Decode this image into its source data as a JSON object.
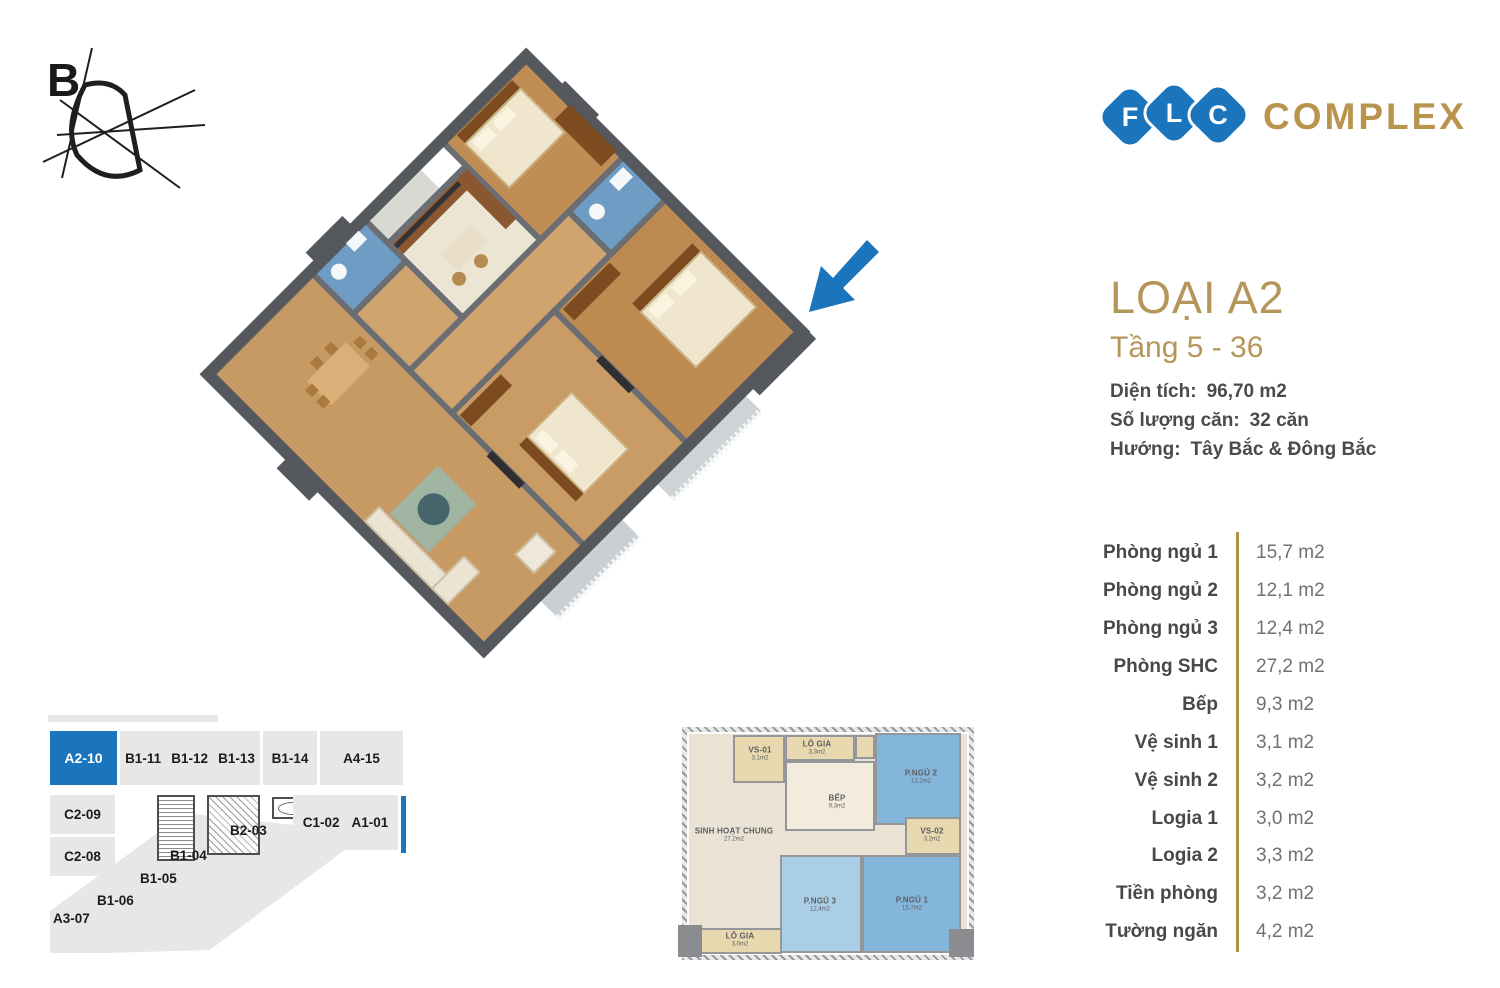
{
  "compass": {
    "label": "B"
  },
  "logo": {
    "letters": [
      "F",
      "L",
      "C"
    ],
    "word": "COMPLEX",
    "blue": "#1b75bc",
    "gold": "#b8944e"
  },
  "header": {
    "title": "LOẠI A2",
    "subtitle": "Tầng 5 - 36"
  },
  "info": {
    "rows": [
      {
        "label": "Diện tích:",
        "value": "96,70 m2"
      },
      {
        "label": "Số lượng căn:",
        "value": "32 căn"
      },
      {
        "label": "Hướng:",
        "value": "Tây Bắc & Đông Bắc"
      }
    ]
  },
  "room_list": {
    "divider_color": "#b2914c",
    "rows": [
      {
        "label": "Phòng ngủ 1",
        "value": "15,7 m2"
      },
      {
        "label": "Phòng ngủ 2",
        "value": "12,1 m2"
      },
      {
        "label": "Phòng ngủ 3",
        "value": "12,4 m2"
      },
      {
        "label": "Phòng SHC",
        "value": "27,2 m2"
      },
      {
        "label": "Bếp",
        "value": "9,3 m2"
      },
      {
        "label": "Vệ sinh 1",
        "value": "3,1 m2"
      },
      {
        "label": "Vệ sinh 2",
        "value": "3,2 m2"
      },
      {
        "label": "Logia 1",
        "value": "3,0 m2"
      },
      {
        "label": "Logia 2",
        "value": "3,3 m2"
      },
      {
        "label": "Tiền phòng",
        "value": "3,2 m2"
      },
      {
        "label": "Tường ngăn",
        "value": "4,2 m2"
      }
    ]
  },
  "key_plan": {
    "highlight_color": "#1b75bc",
    "unit_color": "#e6e7e8",
    "highlighted_unit": "A2-10",
    "units": [
      {
        "label": "A2-10"
      },
      {
        "label": "B1-11"
      },
      {
        "label": "B1-12"
      },
      {
        "label": "B1-13"
      },
      {
        "label": "B1-14"
      },
      {
        "label": "A4-15"
      },
      {
        "label": "C2-09"
      },
      {
        "label": "C2-08"
      },
      {
        "label": "B2-03"
      },
      {
        "label": "C1-02"
      },
      {
        "label": "A1-01"
      },
      {
        "label": "B1-04"
      },
      {
        "label": "B1-05"
      },
      {
        "label": "B1-06"
      },
      {
        "label": "A3-07"
      }
    ]
  },
  "floor_plan_2d": {
    "rooms": [
      {
        "name": "VS-01",
        "area": "3,1m2"
      },
      {
        "name": "LÔ GIA",
        "area": "3,3m2"
      },
      {
        "name": "BẾP",
        "area": "9,3m2"
      },
      {
        "name": "P.NGỦ 2",
        "area": "12,1m2"
      },
      {
        "name": "VS-02",
        "area": "3,2m2"
      },
      {
        "name": "SINH HOẠT CHUNG",
        "area": "27,2m2"
      },
      {
        "name": "P.NGỦ 3",
        "area": "12,4m2"
      },
      {
        "name": "P.NGỦ 1",
        "area": "15,7m2"
      },
      {
        "name": "LÔ GIA",
        "area": "3,0m2"
      }
    ]
  },
  "colors": {
    "gold_title": "#b6955a",
    "brand_blue": "#1b75bc",
    "bedroom_blue": "#84b5db",
    "bedroom_light_blue": "#abcee7",
    "tan": "#e7d8af",
    "beige": "#e9e2d5"
  }
}
